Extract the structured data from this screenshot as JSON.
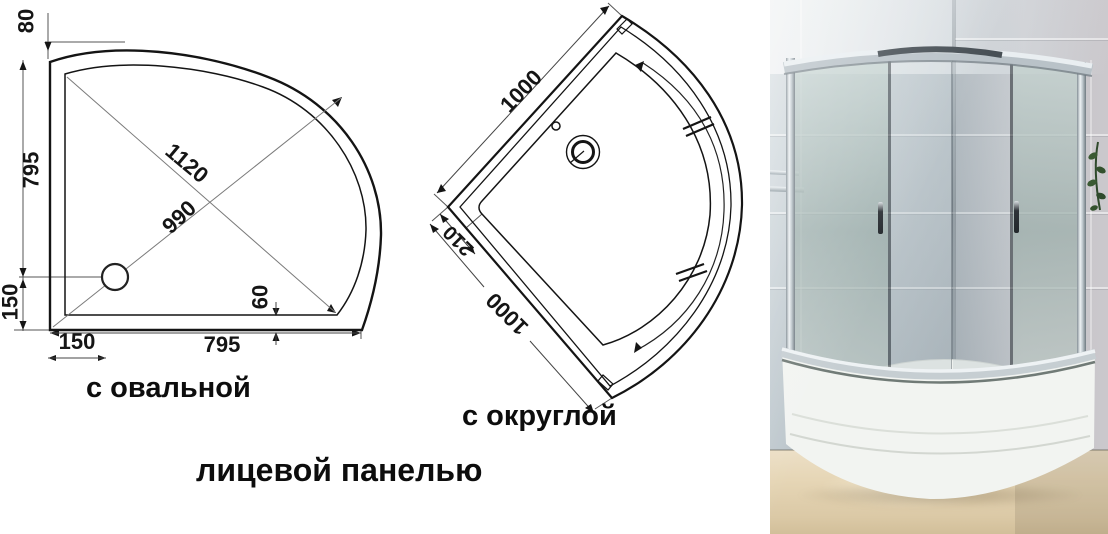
{
  "captions": {
    "oval_panel": "с овальной",
    "round_panel": "с округлой",
    "front_panel": "лицевой панелью"
  },
  "drawing_oval": {
    "dims": {
      "top_offset": "80",
      "side": "795",
      "side_lower": "150",
      "bottom_first": "150",
      "bottom_main": "795",
      "diagonal_long": "1120",
      "diagonal_short": "990",
      "rim_width": "60"
    }
  },
  "drawing_round": {
    "dims": {
      "upper_edge": "1000",
      "corner_depth": "210",
      "lower_edge": "1000"
    }
  },
  "photo": {
    "colors": {
      "wall_left": "#bcc6cc",
      "wall_right": "#c6c4c9",
      "glass_frosted": "#aabbb7",
      "glass_clear": "#ccd5d8",
      "chrome": "#e6ebee",
      "tray_white": "#f2f4f1",
      "floor": "#e4d5b6",
      "plant": "#3c5635"
    }
  }
}
